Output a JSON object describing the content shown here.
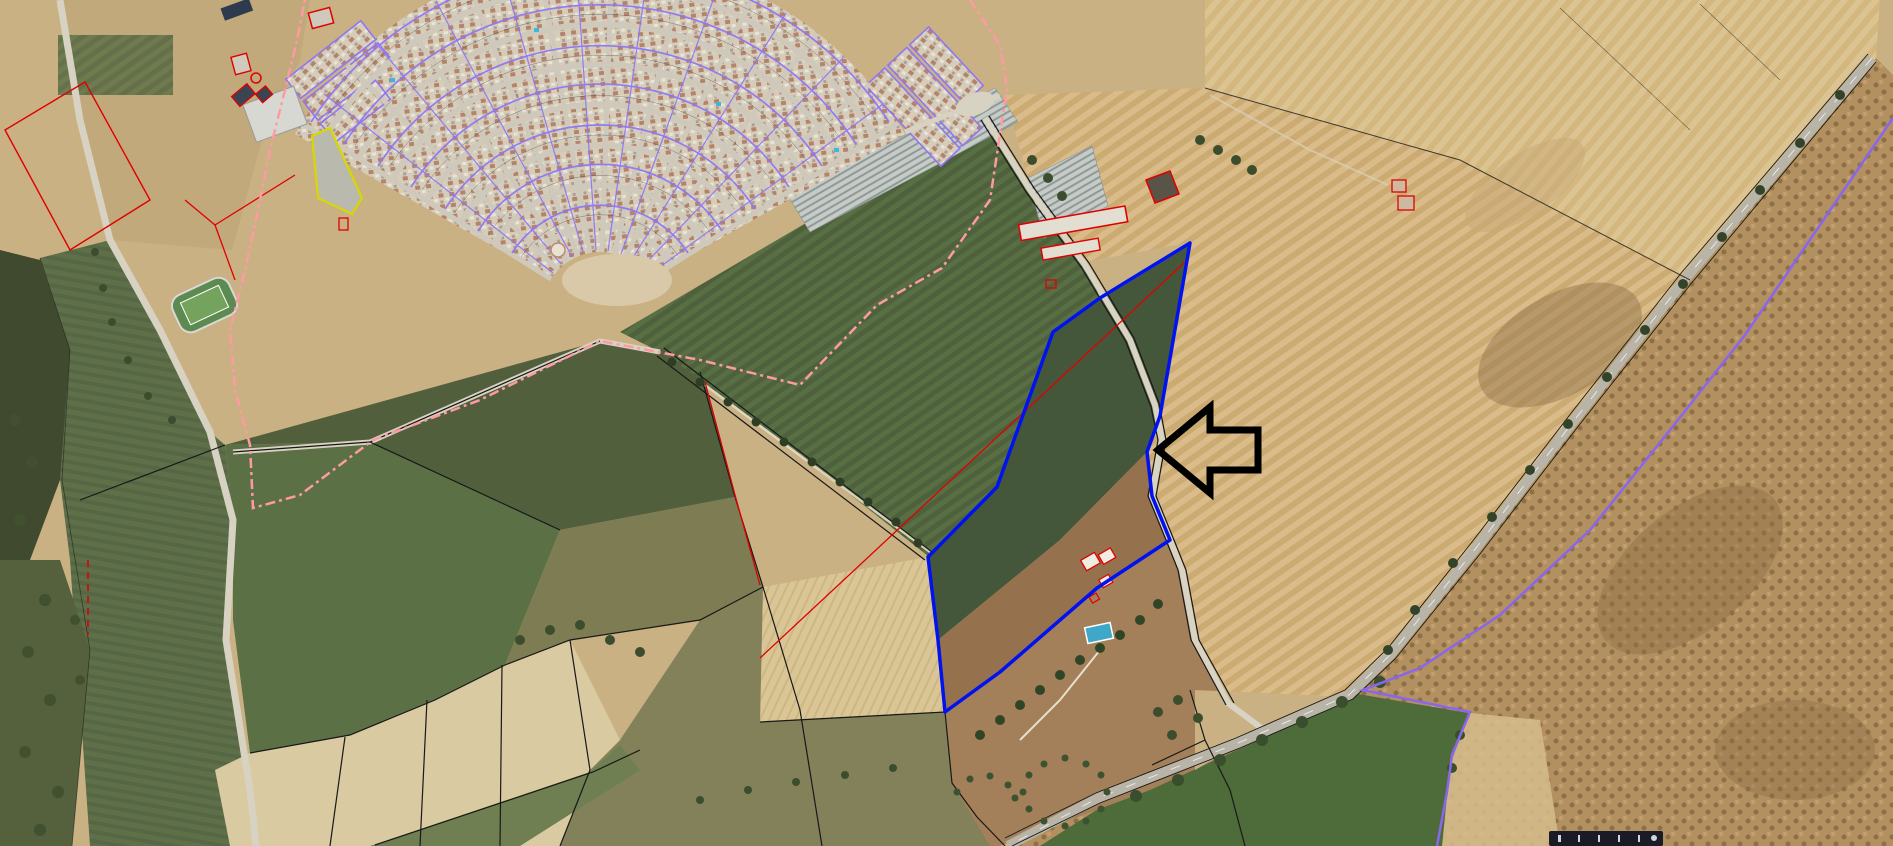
{
  "map": {
    "town_label": "COTO DE BORNOS",
    "highlight_color": "#0012f0",
    "annotation": "left-pointing-arrow",
    "boundary_colors": {
      "urban_pink": "#ff9aa2",
      "municipal_violet": "#8866ee",
      "cadastral_black": "#181818",
      "subparcel_red": "#e00000"
    }
  },
  "map_labels": [
    {
      "text": "COTO DE BORNOS",
      "x": 688,
      "y": 124,
      "cls": "town",
      "name": "town-name-label"
    },
    {
      "text": "CAMINO",
      "x": 222,
      "y": 58,
      "cls": "road",
      "rot": -16,
      "name": "road-name-label"
    },
    {
      "text": "CAMINO DE LOS RECOVEROS",
      "x": 1146,
      "y": 192,
      "cls": "road",
      "rot": -40,
      "name": "road-name-label"
    },
    {
      "text": "98201",
      "x": 435,
      "y": 30,
      "cls": "code"
    },
    {
      "text": "00208",
      "x": 585,
      "y": 15,
      "cls": "code"
    },
    {
      "text": "00208",
      "x": 672,
      "y": 31,
      "cls": "code"
    },
    {
      "text": "02214",
      "x": 900,
      "y": 16,
      "cls": "code"
    },
    {
      "text": "98204",
      "x": 467,
      "y": 73,
      "cls": "code"
    },
    {
      "text": "97204",
      "x": 362,
      "y": 92,
      "cls": "code"
    },
    {
      "text": "01201",
      "x": 747,
      "y": 54,
      "cls": "code"
    },
    {
      "text": "02193",
      "x": 872,
      "y": 64,
      "cls": "code"
    },
    {
      "text": "02195",
      "x": 970,
      "y": 59,
      "cls": "code"
    },
    {
      "text": "99198",
      "x": 537,
      "y": 112,
      "cls": "code"
    },
    {
      "text": "00199",
      "x": 692,
      "y": 108,
      "cls": "code"
    },
    {
      "text": "98198",
      "x": 401,
      "y": 143,
      "cls": "code"
    },
    {
      "text": "99193",
      "x": 572,
      "y": 161,
      "cls": "code"
    },
    {
      "text": "00193",
      "x": 687,
      "y": 170,
      "cls": "code"
    },
    {
      "text": "01193",
      "x": 797,
      "y": 175,
      "cls": "code"
    },
    {
      "text": "98195",
      "x": 440,
      "y": 189,
      "cls": "code"
    },
    {
      "text": "01196",
      "x": 837,
      "y": 115,
      "cls": "code"
    },
    {
      "text": "03198",
      "x": 912,
      "y": 139,
      "cls": "code"
    },
    {
      "text": "02189",
      "x": 940,
      "y": 185,
      "cls": "code"
    },
    {
      "text": "02181",
      "x": 842,
      "y": 235,
      "cls": "code"
    },
    {
      "text": "01195",
      "x": 759,
      "y": 215,
      "cls": "code"
    },
    {
      "text": "99189",
      "x": 642,
      "y": 210,
      "cls": "code"
    },
    {
      "text": "99181",
      "x": 582,
      "y": 219,
      "cls": "code"
    },
    {
      "text": "98187",
      "x": 547,
      "y": 232,
      "cls": "code"
    },
    {
      "text": "98182",
      "x": 482,
      "y": 243,
      "cls": "code"
    },
    {
      "text": "99173",
      "x": 597,
      "y": 249,
      "cls": "code"
    },
    {
      "text": "99175",
      "x": 652,
      "y": 243,
      "cls": "code"
    },
    {
      "text": "00174",
      "x": 727,
      "y": 256,
      "cls": "code"
    },
    {
      "text": "98173",
      "x": 497,
      "y": 285,
      "cls": "code"
    },
    {
      "text": "00172",
      "x": 717,
      "y": 285,
      "cls": "code"
    },
    {
      "text": "00171",
      "x": 699,
      "y": 305,
      "cls": "code"
    },
    {
      "text": "01172",
      "x": 792,
      "y": 305,
      "cls": "code"
    },
    {
      "text": "99176",
      "x": 657,
      "y": 320,
      "cls": "code"
    },
    {
      "text": "50",
      "x": 703,
      "y": 373,
      "cls": "num"
    },
    {
      "text": "88",
      "x": 1181,
      "y": 742,
      "cls": "num"
    },
    {
      "text": "89",
      "x": 1064,
      "y": 727,
      "cls": "num"
    },
    {
      "text": "90",
      "x": 1057,
      "y": 525,
      "cls": "num"
    },
    {
      "text": "91",
      "x": 1037,
      "y": 357,
      "cls": "num"
    },
    {
      "text": "92",
      "x": 1052,
      "y": 186,
      "cls": "num"
    },
    {
      "text": "93",
      "x": 478,
      "y": 404,
      "cls": "num"
    },
    {
      "text": "94",
      "x": 848,
      "y": 595,
      "cls": "num"
    },
    {
      "text": "95",
      "x": 856,
      "y": 827,
      "cls": "num"
    },
    {
      "text": "97",
      "x": 562,
      "y": 549,
      "cls": "num"
    },
    {
      "text": "98",
      "x": 325,
      "y": 625,
      "cls": "num"
    },
    {
      "text": "99",
      "x": 540,
      "y": 727,
      "cls": "num"
    },
    {
      "text": "114",
      "x": 165,
      "y": 634,
      "cls": "num"
    },
    {
      "text": "115",
      "x": 49,
      "y": 225,
      "cls": "num"
    },
    {
      "text": "149",
      "x": 234,
      "y": 218,
      "cls": "num"
    },
    {
      "text": "162",
      "x": 468,
      "y": 759,
      "cls": "num"
    },
    {
      "text": "163",
      "x": 388,
      "y": 788,
      "cls": "num"
    },
    {
      "text": "164",
      "x": 306,
      "y": 813,
      "cls": "num"
    },
    {
      "text": "174",
      "x": 329,
      "y": 176,
      "cls": "num"
    },
    {
      "text": "39",
      "x": 1352,
      "y": 773,
      "cls": "num"
    },
    {
      "text": "85",
      "x": 1318,
      "y": 149,
      "cls": "numdark"
    },
    {
      "text": "86",
      "x": 1091,
      "y": 328,
      "cls": "numdark"
    },
    {
      "text": "90",
      "x": 1874,
      "y": 96,
      "cls": "reded"
    },
    {
      "text": "a",
      "x": 71,
      "y": 170,
      "cls": "letter"
    },
    {
      "text": "b",
      "x": 53,
      "y": 246,
      "cls": "letter"
    },
    {
      "text": "a",
      "x": 221,
      "y": 210,
      "cls": "letter"
    },
    {
      "text": "b",
      "x": 288,
      "y": 237,
      "cls": "letter"
    },
    {
      "text": "a",
      "x": 1029,
      "y": 330,
      "cls": "letter"
    },
    {
      "text": "b",
      "x": 810,
      "y": 392,
      "cls": "letter"
    },
    {
      "text": "b",
      "x": 1047,
      "y": 406,
      "cls": "letter"
    },
    {
      "text": "a",
      "x": 830,
      "y": 526,
      "cls": "letter"
    },
    {
      "text": "b",
      "x": 863,
      "y": 648,
      "cls": "letter"
    },
    {
      "text": "a",
      "x": 1338,
      "y": 808,
      "cls": "letter"
    },
    {
      "text": "a",
      "x": 1094,
      "y": 225,
      "cls": "letter"
    },
    {
      "text": "a",
      "x": 1249,
      "y": 62,
      "cls": "letter"
    }
  ]
}
